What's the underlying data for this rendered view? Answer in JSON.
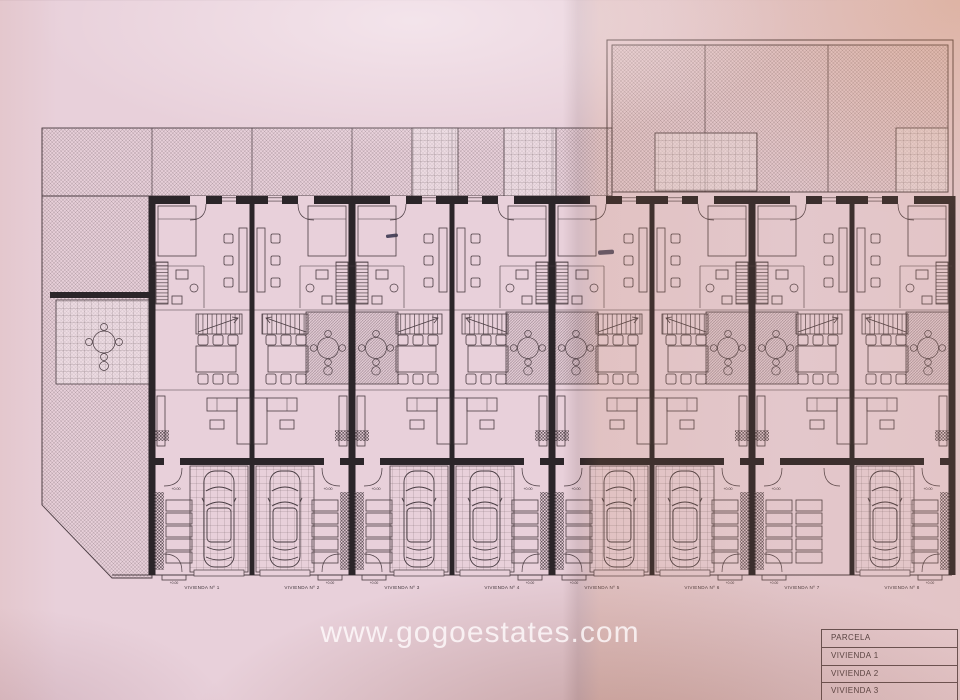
{
  "watermark": {
    "text": "www.gogoestates.com"
  },
  "legend": {
    "rows": [
      {
        "label": "PARCELA"
      },
      {
        "label": "VIVIENDA 1"
      },
      {
        "label": "VIVIENDA 2"
      },
      {
        "label": "VIVIENDA 3"
      }
    ]
  },
  "plan": {
    "level_mark": "+0.00",
    "units": [
      {
        "label": "VIVIENDA Nº 1",
        "has_car": true
      },
      {
        "label": "VIVIENDA Nº 2",
        "has_car": true
      },
      {
        "label": "VIVIENDA Nº 3",
        "has_car": true
      },
      {
        "label": "VIVIENDA Nº 4",
        "has_car": true
      },
      {
        "label": "VIVIENDA Nº 5",
        "has_car": true
      },
      {
        "label": "VIVIENDA Nº 6",
        "has_car": true
      },
      {
        "label": "VIVIENDA Nº 7",
        "has_car": false
      },
      {
        "label": "VIVIENDA Nº 8",
        "has_car": true
      }
    ]
  },
  "colors": {
    "paper": "#e8d0da",
    "ink": "#4a3c42",
    "wall": "#2b2529",
    "hatch": "#6a575e"
  }
}
